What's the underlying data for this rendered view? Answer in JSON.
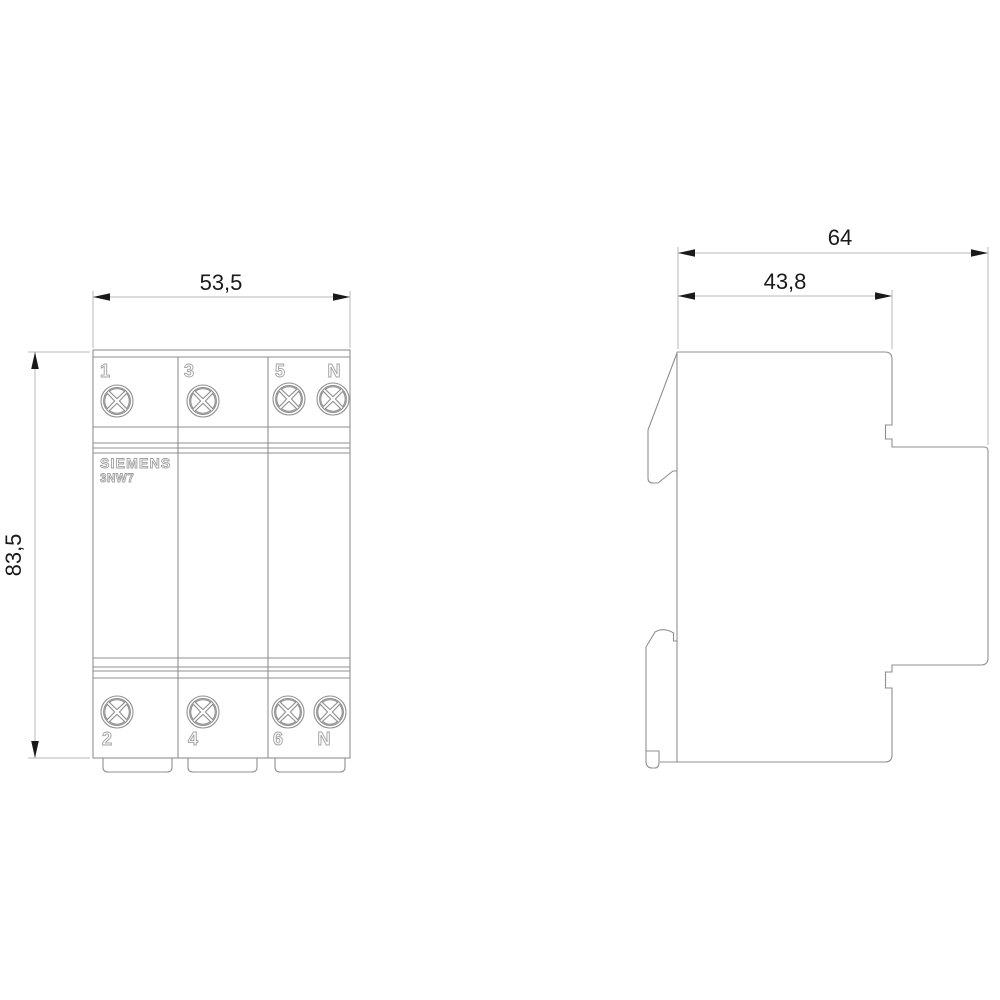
{
  "front_view": {
    "brand": "SIEMENS",
    "model": "3NW7",
    "top_terminals": [
      "1",
      "3",
      "5",
      "N"
    ],
    "bottom_terminals": [
      "2",
      "4",
      "6",
      "N"
    ],
    "dim_width_mm": "53,5",
    "dim_height_mm": "83,5"
  },
  "side_view": {
    "dim_total_depth_mm": "64",
    "dim_front_depth_mm": "43,8"
  },
  "colors": {
    "background": "#ffffff",
    "device_outline": "#8f8f8f",
    "dimension_line": "#b8b8b8",
    "dimension_text": "#1a1a1a",
    "label_outline": "#a0a0a0"
  }
}
